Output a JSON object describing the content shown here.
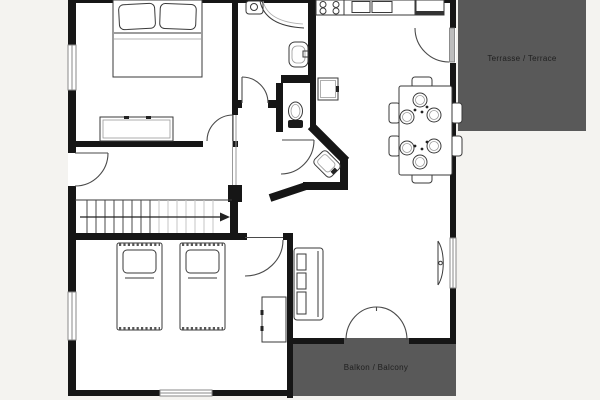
{
  "plan": {
    "terrace": {
      "label": "Terrasse / Terrace"
    },
    "balcony": {
      "label": "Balkon / Balcony"
    }
  },
  "colors": {
    "deck": "#595959",
    "wall": "#161616",
    "floor": "#ffffff",
    "background": "#f4f3f0",
    "furniture_line": "#3a3a3a",
    "label_text": "#1f1f1f"
  }
}
